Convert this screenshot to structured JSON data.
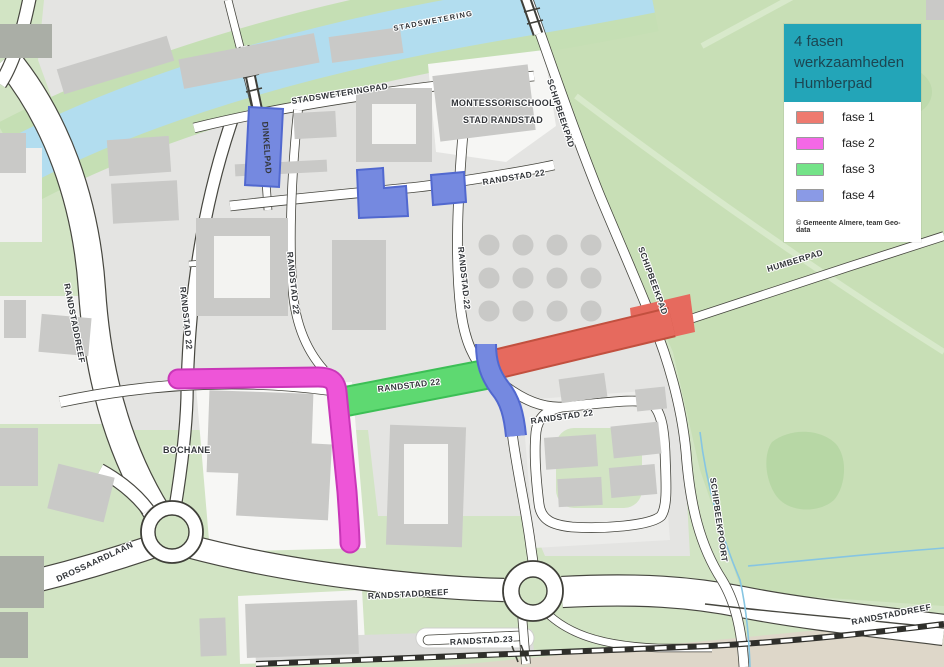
{
  "legend": {
    "title_lines": [
      "4 fasen",
      "werkzaamheden",
      "Humberpad"
    ],
    "header_bg": "#23a5b8",
    "items": [
      {
        "label": "fase 1",
        "color": "#ee7a6f"
      },
      {
        "label": "fase 2",
        "color": "#f468e6"
      },
      {
        "label": "fase 3",
        "color": "#74e388"
      },
      {
        "label": "fase 4",
        "color": "#8a9ae6"
      }
    ],
    "attribution": "© Gemeente Almere, team Geo-data"
  },
  "map_labels": {
    "stadswetering": "STADSWETERING",
    "stadsweteringpad": "STADSWETERINGPAD",
    "dinkelpad": "DINKELPAD",
    "montessorischool_line1": "MONTESSORISCHOOL",
    "montessorischool_line2": "STAD RANDSTAD",
    "schipbeekpad": "SCHIPBEEKPAD",
    "schipbeekpoort": "SCHIPBEEKPOORT",
    "humberpad": "HUMBERPAD",
    "randstad22": "RANDSTAD 22",
    "randstad23": "RANDSTAD 23",
    "randstaddreef": "RANDSTADDREEF",
    "drossaardlaan": "DROSSAARDLAAN",
    "bochane": "BOCHANE"
  },
  "map_colors": {
    "land": "#d2e4c4",
    "park": "#c8dfb6",
    "water": "#b2ddef",
    "urban": "#e4e4e2",
    "fase1": "#e66a5e",
    "fase2": "#ee55d8",
    "fase3": "#5ed971",
    "fase4": "#7589e0"
  }
}
